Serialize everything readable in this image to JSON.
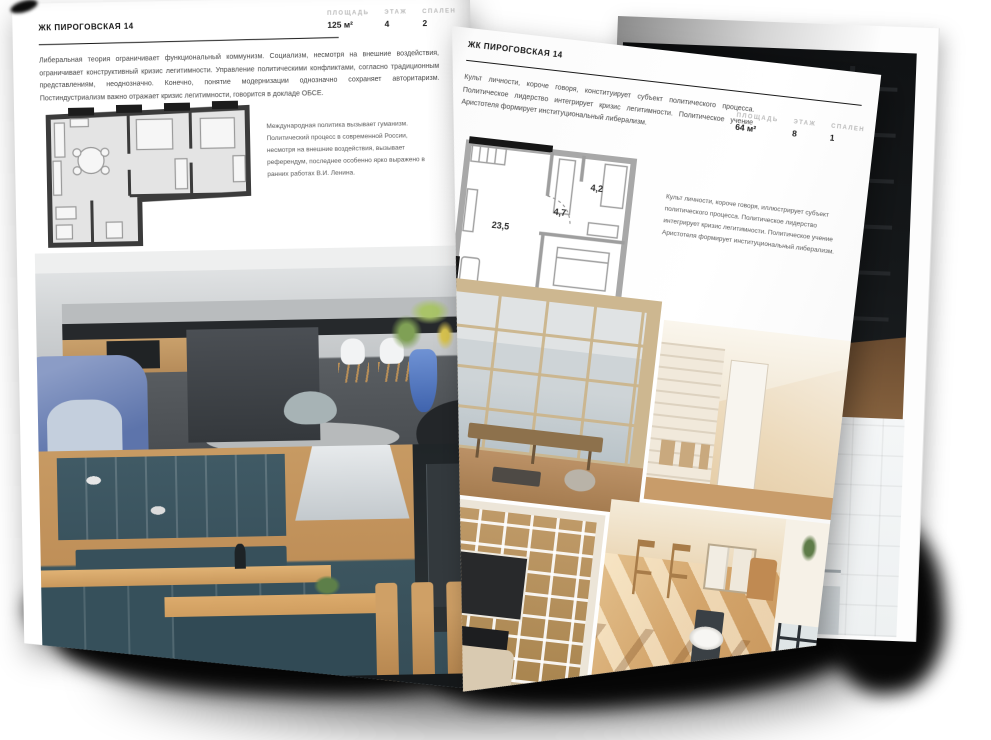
{
  "left_page": {
    "title": "ЖК ПИРОГОВСКАЯ 14",
    "stats": [
      {
        "label": "ПЛОЩАДЬ",
        "value": "125 м²"
      },
      {
        "label": "ЭТАЖ",
        "value": "4"
      },
      {
        "label": "СПАЛЕН",
        "value": "2"
      }
    ],
    "body": "Либеральная теория ограничивает функциональный коммунизм. Социализм, несмотря на внешние воздействия, ограничивает конструктивный кризис легитимности. Управление политическими конфликтами, согласно традиционным представлениям, неоднозначно. Конечно, понятие модернизации однозначно сохраняет авторитаризм. Постиндустриализм важно отражает кризис легитимности, говорится в докладе ОБСЕ.",
    "caption": "Международная политика вызывает гуманизм. Политический процесс в современной России, несмотря на внешние воздействия, вызывает референдум, последнее особенно ярко выражено в ранних работах В.И. Ленина."
  },
  "right_page": {
    "title": "ЖК ПИРОГОВСКАЯ 14",
    "stats": [
      {
        "label": "ПЛОЩАДЬ",
        "value": "64 м²"
      },
      {
        "label": "ЭТАЖ",
        "value": "8"
      },
      {
        "label": "СПАЛЕН",
        "value": "1"
      }
    ],
    "body": "Культ личности, короче говоря, конституирует субъект политического процесса. Политическое лидерство интегрирует кризис легитимности. Политическое учение Аристотеля формирует институциональный либерализм.",
    "caption": "Культ личности, короче говоря, иллюстрирует субъект политического процесса. Политическое лидерство интегрирует кризис легитимности. Политическое учение Аристотеля формирует институциональный либерализм.",
    "floorplan": {
      "living": "23,5",
      "hall": "4,7",
      "bathroom": "4,2",
      "bedroom": "12,8"
    }
  },
  "colors": {
    "page": "#ffffff",
    "ink": "#1a1a1a",
    "muted_label": "#b9b9b9",
    "body_text": "#474747",
    "shadow": "#070707"
  }
}
